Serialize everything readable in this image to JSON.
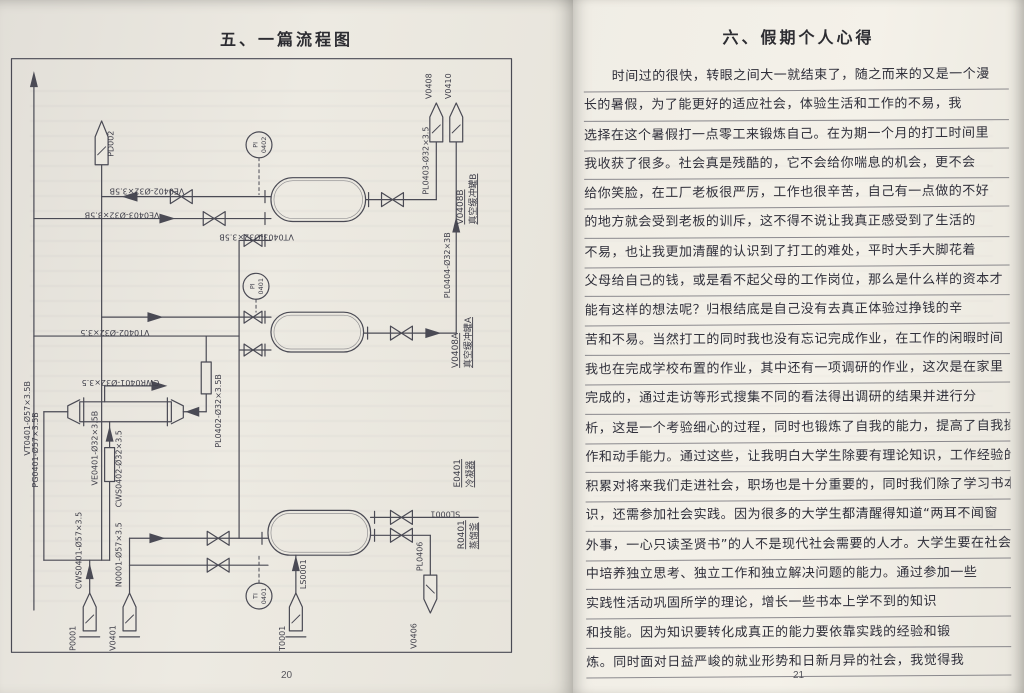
{
  "left_page": {
    "title": "五、一篇流程图",
    "page_number": "20",
    "diagram": {
      "flags": {
        "pd002": "PD002",
        "v0408": "V0408",
        "v0410": "V0410",
        "p0001": "P0001",
        "v0401": "V0401",
        "t0001": "T0001",
        "v0406": "V0406"
      },
      "lines": {
        "vt0401": "VT0401-Ø57×3.5B",
        "ve0401": "VE0401-Ø32×3.5B",
        "ve0402": "VE0402-Ø32×3.5B",
        "ve0403": "VE0403-Ø32×3.5B",
        "vt0403": "VT0403-Ø32×3.5B",
        "vt0402": "VT0402-Ø32×3.5",
        "pl0402": "PL0402-Ø32×3.5B",
        "pl0403": "PL0403-Ø32×3.5",
        "pl0404": "PL0404-Ø32×3B",
        "pl0406": "PL0406",
        "sl0001": "SL0001",
        "ls0001": "LS0001",
        "cwr0401": "CWR0401-Ø32×3.5",
        "cws0401": "CWS0401-Ø57×3.5",
        "cws0402": "CWS0402-Ø32×3.5",
        "pg0401": "PG0401-Ø57×3.5B",
        "n0001": "N0001-Ø57×3.5"
      },
      "instruments": {
        "pi0402": {
          "tag": "PI",
          "num": "0402"
        },
        "pi0401": {
          "tag": "PI",
          "num": "0401"
        },
        "ti0401": {
          "tag": "TI",
          "num": "0401"
        }
      },
      "equipment": {
        "v0408b": {
          "code": "V0408B",
          "name": "真空缓冲罐B"
        },
        "v0408a": {
          "code": "V0408A",
          "name": "真空缓冲罐A"
        },
        "e0401": {
          "code": "E0401",
          "name": "冷凝器"
        },
        "r0401": {
          "code": "R0401",
          "name": "蒸馏釜"
        }
      }
    }
  },
  "right_page": {
    "title": "六、假期个人心得",
    "page_number": "21",
    "paragraph_lines": [
      "时间过的很快，转眼之间大一就结束了，随之而来的又是一个漫",
      "长的暑假，为了能更好的适应社会，体验生活和工作的不易，我",
      "选择在这个暑假打一点零工来锻炼自己。在为期一个月的打工时间里",
      "我收获了很多。社会真是残酷的，它不会给你喘息的机会，更不会",
      "给你笑脸，在工厂老板很严厉，工作也很辛苦，自己有一点做的不好",
      "的地方就会受到老板的训斥，这不得不说让我真正感受到了生活的",
      "不易，也让我更加清醒的认识到了打工的难处，平时大手大脚花着",
      "父母给自己的钱，或是看不起父母的工作岗位，那么是什么样的资本才",
      "能有这样的想法呢？归根结底是自己没有去真正体验过挣钱的辛",
      "苦和不易。当然打工的同时我也没有忘记完成作业，在工作的闲暇时间",
      "我也在完成学校布置的作业，其中还有一项调研的作业，这次是在家里",
      "完成的，通过走访等形式搜集不同的看法得出调研的结果并进行分",
      "析，这是一个考验细心的过程，同时也锻炼了自我的能力，提高了自我操",
      "作和动手能力。通过这些，让我明白大学生除要有理论知识，工作经验的",
      "积累对将来我们走进社会，职场也是十分重要的，同时我们除了学习书本知",
      "识，还需参加社会实践。因为很多的大学生都清醒得知道“两耳不闻窗",
      "外事，一心只读圣贤书”的人不是现代社会需要的人才。大学生要在社会实践",
      "中培养独立思考、独立工作和独立解决问题的能力。通过参加一些",
      "实践性活动巩固所学的理论，增长一些书本上学不到的知识",
      "和技能。因为知识要转化成真正的能力要依靠实践的经验和锻",
      "炼。同时面对日益严峻的就业形势和日新月异的社会，我觉得我"
    ]
  }
}
